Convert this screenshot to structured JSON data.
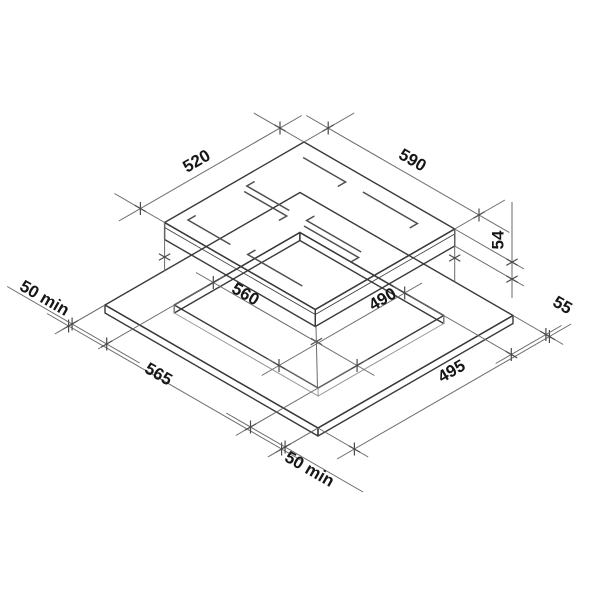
{
  "diagram": {
    "kind": "hob-installation-dimension-drawing",
    "dimensions": {
      "hob_top_left_edge": "520",
      "hob_top_right_edge": "590",
      "hob_height": "54",
      "cutout_left_edge": "560",
      "cutout_right_edge": "490",
      "counter_front_left_edge": "565",
      "counter_front_right_edge": "495",
      "margin_right": "55",
      "margin_left": "50 min",
      "margin_bottom": "50 min"
    },
    "colors": {
      "glass_top": "#c7c7c7",
      "hob_side_left": "#fbfbfb",
      "hob_side_right": "#efefef",
      "counter_top": "#f2f2f2",
      "counter_side_left": "#e7e7e7",
      "counter_side_right": "#dcdcdc",
      "counter_inner_wall": "#e9e9e9",
      "background": "#ffffff"
    }
  }
}
